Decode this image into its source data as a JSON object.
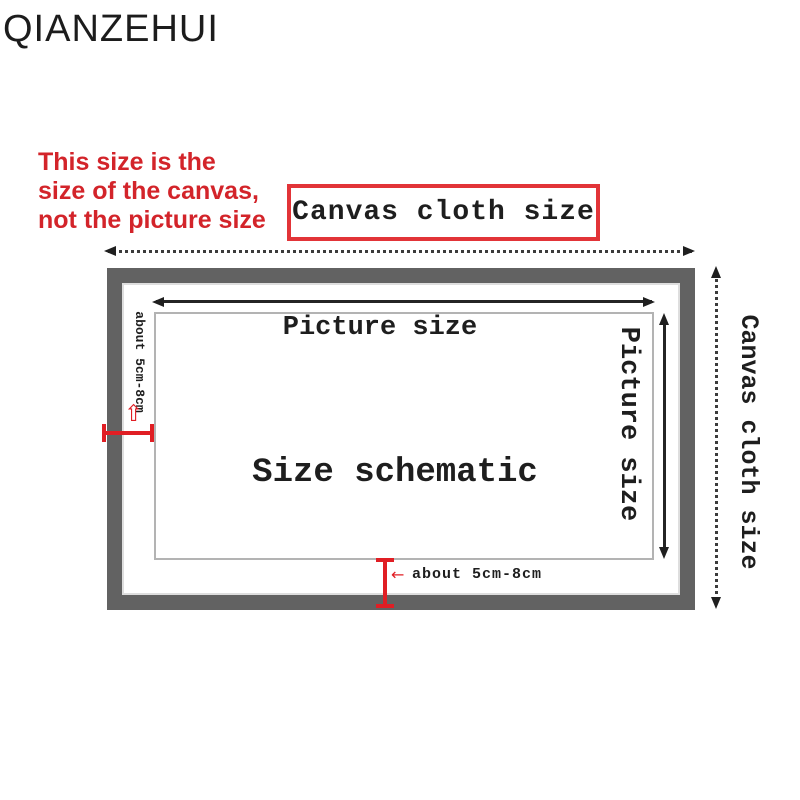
{
  "brand": "QIANZEHUI",
  "warning": {
    "line1": "This size is the",
    "line2": "size of the canvas,",
    "line3": "not the picture size"
  },
  "labels": {
    "canvas_cloth_top": "Canvas cloth size",
    "canvas_cloth_right": "Canvas cloth size",
    "picture_size_top": "Picture size",
    "picture_size_right": "Picture size",
    "size_schematic": "Size schematic",
    "about_left": "about 5cm-8cm",
    "about_bottom": "about 5cm-8cm"
  },
  "icons": {
    "up_arrow": "⇧",
    "left_arrow": "←"
  },
  "colors": {
    "accent_red": "#e01e24",
    "warning_red": "#d3242a",
    "frame_gray": "#626262",
    "line_dark": "#2a2a2a"
  }
}
